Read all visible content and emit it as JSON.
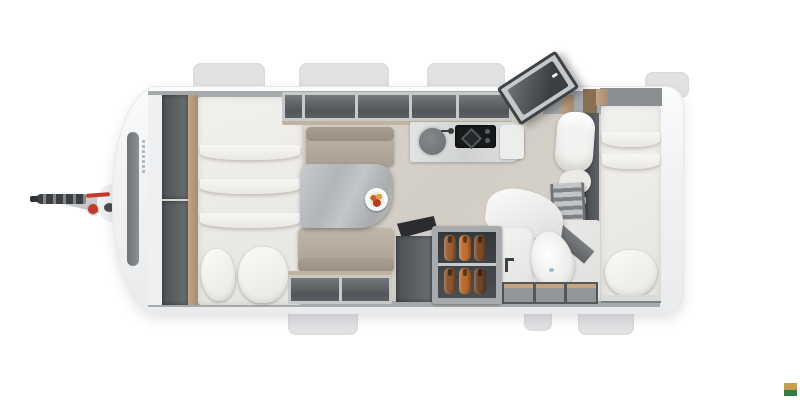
{
  "page": {
    "type": "caravan-floorplan-top-view-3d-render",
    "background": "#ffffff"
  },
  "palette": {
    "shell": "#f1f2f4",
    "floor": "#d6d2ca",
    "cabinet_dark": "#55585c",
    "wood_trim": "#b3976f",
    "upholstery": "#b6ad9f",
    "bedding": "#f0efec",
    "counter_marble": "#d7d9d8",
    "table_marble": "#b6b9bb",
    "accent_red": "#c4392c"
  },
  "watermark": {
    "top_color": "#c89a4b",
    "bottom_color": "#2e7d46"
  },
  "furniture": {
    "front": [
      "tow-hitch",
      "jockey-wheel-red-knob",
      "front-window"
    ],
    "left_bedroom": [
      "wardrobe-columns",
      "double-bed",
      "pillow",
      "pillow"
    ],
    "dinette": [
      "overhead-lockers",
      "bench-seat",
      "bench-seat",
      "marble-table",
      "plate-with-food"
    ],
    "kitchen": [
      "overhead-lockers",
      "round-sink",
      "tap",
      "two-burner-hob",
      "worktop-extension"
    ],
    "entrance": [
      "open-entry-door-with-window",
      "entry-step-cabinet"
    ],
    "storage": [
      "tv-bracket",
      "base-cabinet",
      "fridge-with-bottles"
    ],
    "bathroom": [
      "curved-shower-wall",
      "toilet",
      "vanity-with-tap",
      "wood-top-drawers"
    ],
    "rear_bedroom": [
      "bunk-rolled-duvet",
      "bunk-ladder",
      "single-bed",
      "pillow"
    ]
  }
}
